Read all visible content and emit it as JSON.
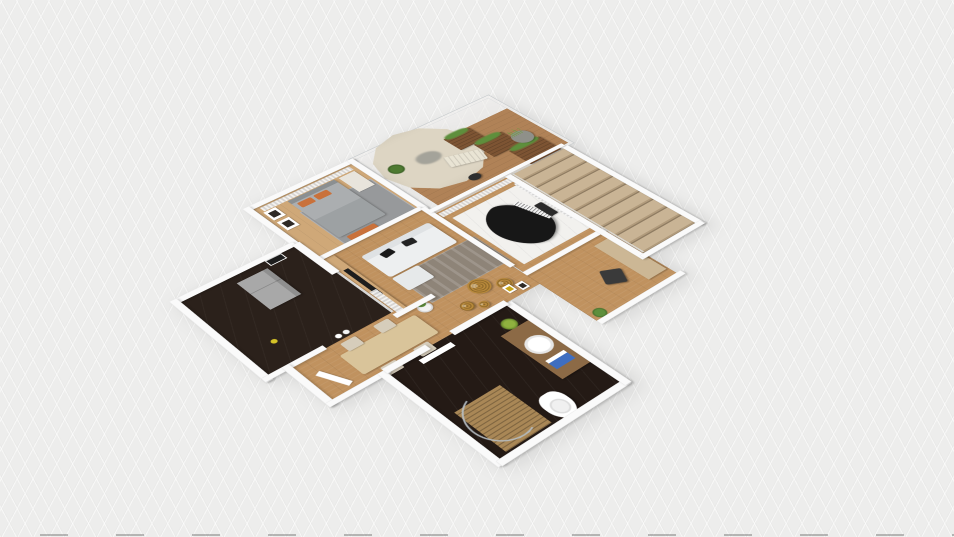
{
  "app": {
    "name": "3D floor plan viewer",
    "view_mode": "3d-orbit-perspective",
    "visible_text": "none",
    "canvas_background": "#ededec"
  },
  "palette": {
    "floorWood": "#c0925f",
    "floorWoodLight": "#cfa878",
    "deck": "#b08257",
    "floorDark": "#2b211b",
    "floorBathDark": "#241a15",
    "marble": "#f2f1ee",
    "wall": "#fafafa",
    "rugGray": "#97999b",
    "rugTaupe": "#8e8478",
    "sofa": "#edeff0",
    "bedGray": "#abaeb0",
    "pillowOrange": "#c9713b",
    "umbrella": "#ddd5c3",
    "planterWood": "#7d5433",
    "plantGreen": "#5e8f3c",
    "pouf": "#b8893b",
    "piano": "#171717",
    "stairStep": "#c9b495",
    "stairShadow": "#8f7c62",
    "fridge": "#a8a8a8",
    "towelBlue": "#3f6ec0",
    "tableWood": "#d9c49a",
    "chairBeige": "#d6cdbb"
  },
  "rooms": [
    {
      "id": "bedroom",
      "label": "Bedroom",
      "floor": "wood with gray rug"
    },
    {
      "id": "balcony",
      "label": "Balcony terrace",
      "floor": "wood deck, glass railing"
    },
    {
      "id": "kitchen",
      "label": "Kitchen",
      "floor": "dark marble"
    },
    {
      "id": "living-room",
      "label": "Living room",
      "floor": "wood"
    },
    {
      "id": "dining-hall",
      "label": "Dining / hallway",
      "floor": "wood"
    },
    {
      "id": "bathroom",
      "label": "Bathroom",
      "floor": "dark marble"
    },
    {
      "id": "piano-room",
      "label": "Piano room",
      "floor": "wood with white marble rug"
    },
    {
      "id": "stairwell",
      "label": "Stairs",
      "floor": "beige treads"
    },
    {
      "id": "study",
      "label": "Study corner",
      "floor": "wood"
    }
  ],
  "furniture": [
    {
      "id": "bed",
      "label": "Double bed with orange pillows",
      "room": "bedroom"
    },
    {
      "id": "wall-art",
      "label": "Two framed pictures",
      "room": "bedroom"
    },
    {
      "id": "parasol",
      "label": "Round cream parasol",
      "room": "balcony"
    },
    {
      "id": "lounger",
      "label": "Sun lounger",
      "room": "balcony"
    },
    {
      "id": "planters",
      "label": "Wooden planter boxes with plants",
      "room": "balcony"
    },
    {
      "id": "grass-pot",
      "label": "Round pot with tall grass",
      "room": "balcony"
    },
    {
      "id": "fridge",
      "label": "Refrigerator",
      "room": "kitchen"
    },
    {
      "id": "tv-wall",
      "label": "Wood TV wall",
      "room": "living-room"
    },
    {
      "id": "sofa",
      "label": "White sofa with black cushions",
      "room": "living-room"
    },
    {
      "id": "rug",
      "label": "Gray area rug",
      "room": "living-room"
    },
    {
      "id": "poufs",
      "label": "Gold round poufs",
      "room": "living-room"
    },
    {
      "id": "dining-table",
      "label": "Dining table with four chairs",
      "room": "dining-hall"
    },
    {
      "id": "shower",
      "label": "Shower with wooden mat and curved glass",
      "room": "bathroom"
    },
    {
      "id": "vanity-sink",
      "label": "Vanity with round sink",
      "room": "bathroom"
    },
    {
      "id": "towel",
      "label": "Blue towel",
      "room": "bathroom"
    },
    {
      "id": "toilet",
      "label": "Toilet",
      "room": "bathroom"
    },
    {
      "id": "grand-piano",
      "label": "Black grand piano with bench",
      "room": "piano-room"
    },
    {
      "id": "desk",
      "label": "Desk cabinet",
      "room": "study"
    },
    {
      "id": "desk-chair",
      "label": "Dark chair",
      "room": "study"
    }
  ]
}
